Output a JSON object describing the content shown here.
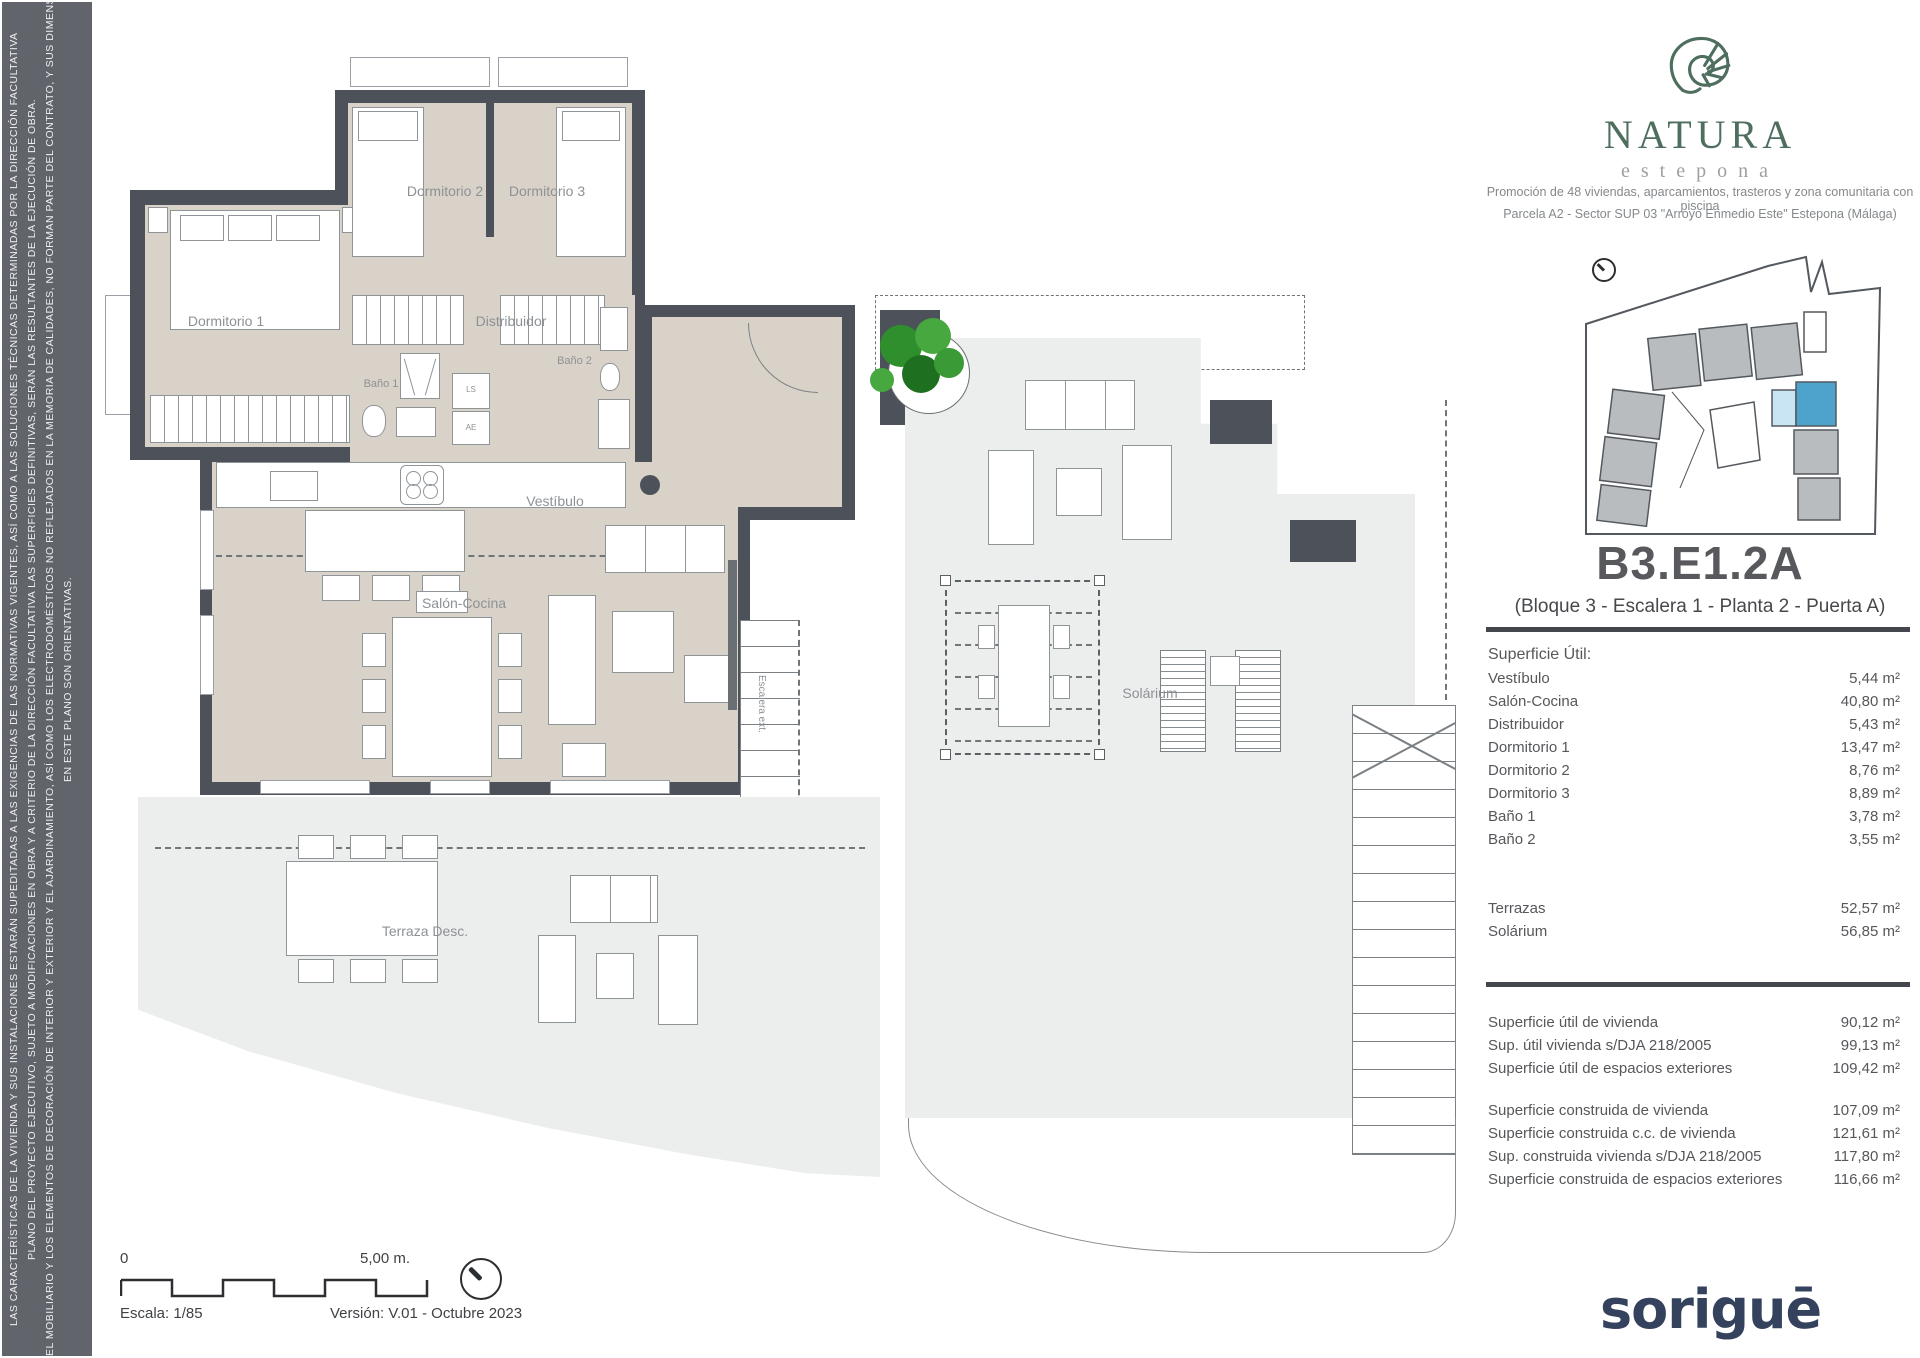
{
  "disclaimer": {
    "lines": [
      "LAS CARACTERÍSTICAS DE LA VIVIENDA Y SUS INSTALACIONES ESTARÁN SUPEDITADAS A LAS EXIGENCIAS DE LAS NORMATIVAS VIGENTES, ASÍ COMO A LAS SOLUCIONES TÉCNICAS DETERMINADAS POR LA DIRECCIÓN FACULTATIVA",
      "PLANO DEL PROYECTO EJECUTIVO, SUJETO A MODIFICACIONES EN OBRA Y A CRITERIO DE LA DIRECCIÓN FACULTATIVA LAS SUPERFICIES DEFINITIVAS, SERÁN LAS RESULTANTES DE LA EJECUCIÓN DE OBRA.",
      "EL MOBILIARIO Y LOS ELEMENTOS DE DECORACIÓN DE INTERIOR Y EXTERIOR Y EL AJARDINAMIENTO, ASÍ COMO LOS ELECTRODOMÉSTICOS NO REFLEJADOS EN LA MEMORIA DE CALIDADES, NO FORMAN PARTE DEL CONTRATO, Y SUS DIMENSIONES Y UBICACIÓN",
      "EN ESTE PLANO SON ORIENTATIVAS."
    ]
  },
  "brand": {
    "name": "NATURA",
    "subtitle": "estepona",
    "promo_line1": "Promoción de 48 viviendas, aparcamientos, trasteros y zona comunitaria con piscina",
    "promo_line2": "Parcela A2 - Sector SUP 03 \"Arroyo Enmedio Este\" Estepona (Málaga)"
  },
  "unit": {
    "code": "B3.E1.2A",
    "subtitle": "(Bloque 3 - Escalera 1 - Planta 2 - Puerta A)"
  },
  "surfaces": {
    "title": "Superficie Útil:",
    "rooms": [
      {
        "label": "Vestíbulo",
        "value": "5,44 m²"
      },
      {
        "label": "Salón-Cocina",
        "value": "40,80 m²"
      },
      {
        "label": "Distribuidor",
        "value": "5,43 m²"
      },
      {
        "label": "Dormitorio 1",
        "value": "13,47 m²"
      },
      {
        "label": "Dormitorio 2",
        "value": "8,76 m²"
      },
      {
        "label": "Dormitorio 3",
        "value": "8,89 m²"
      },
      {
        "label": "Baño 1",
        "value": "3,78 m²"
      },
      {
        "label": "Baño 2",
        "value": "3,55 m²"
      }
    ],
    "exterior": [
      {
        "label": "Terrazas",
        "value": "52,57 m²"
      },
      {
        "label": "Solárium",
        "value": "56,85 m²"
      }
    ],
    "util_totals": [
      {
        "label": "Superficie útil de vivienda",
        "value": "90,12 m²"
      },
      {
        "label": "Sup. útil vivienda s/DJA 218/2005",
        "value": "99,13 m²"
      },
      {
        "label": "Superficie útil de espacios exteriores",
        "value": "109,42 m²"
      }
    ],
    "built_totals": [
      {
        "label": "Superficie construida de vivienda",
        "value": "107,09 m²"
      },
      {
        "label": "Superficie construida c.c. de vivienda",
        "value": "121,61 m²"
      },
      {
        "label": "Sup. construida vivienda s/DJA 218/2005",
        "value": "117,80 m²"
      },
      {
        "label": "Superficie construida de espacios exteriores",
        "value": "116,66 m²"
      }
    ]
  },
  "floorplan": {
    "dormitorio1": "Dormitorio 1",
    "dormitorio2": "Dormitorio 2",
    "dormitorio3": "Dormitorio 3",
    "distribuidor": "Distribuidor",
    "bano1": "Baño 1",
    "bano2": "Baño 2",
    "vestibulo": "Vestíbulo",
    "salon_cocina": "Salón-Cocina",
    "terraza": "Terraza Desc.",
    "escalera": "Escalera ext.",
    "closet_top": "LS",
    "closet_bottom": "AE"
  },
  "solarium": {
    "label": "Solárium"
  },
  "footer": {
    "scale_zero": "0",
    "scale_length": "5,00 m.",
    "scale_text": "Escala: 1/85",
    "version_text": "Versión: V.01 - Octubre 2023"
  },
  "company": {
    "logo_text": "soriguē"
  },
  "colors": {
    "brand_green": "#4e6e5e",
    "logo_navy": "#35425e",
    "wall_gray": "#4d525a",
    "floor_beige": "#d9d2c8",
    "floor_gray": "#eceeed",
    "site_highlight_blue": "#4da3cc",
    "site_highlight_light": "#c9e4f2"
  }
}
